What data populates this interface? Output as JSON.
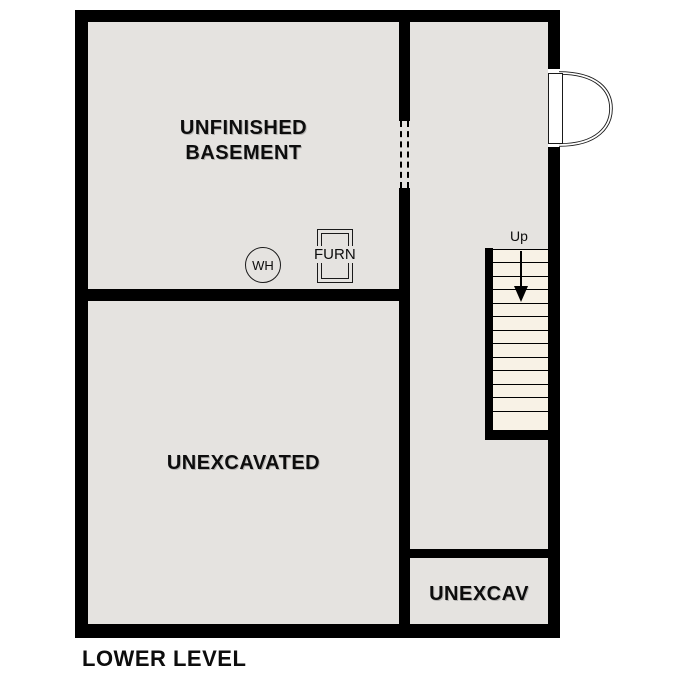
{
  "title": "LOWER LEVEL",
  "colors": {
    "wall": "#000000",
    "room": "#e5e3e0",
    "stair": "#f8f2e6",
    "bg": "#ffffff",
    "ink": "#111111"
  },
  "rooms": {
    "basement": {
      "label": "UNFINISHED\nBASEMENT"
    },
    "unexcavated": {
      "label": "UNEXCAVATED"
    },
    "unexcav_small": {
      "label": "UNEXCAV"
    }
  },
  "equipment": {
    "water_heater": {
      "label": "WH"
    },
    "furnace": {
      "label": "FURN"
    }
  },
  "stairs": {
    "direction_label": "Up",
    "tread_count": 12
  }
}
